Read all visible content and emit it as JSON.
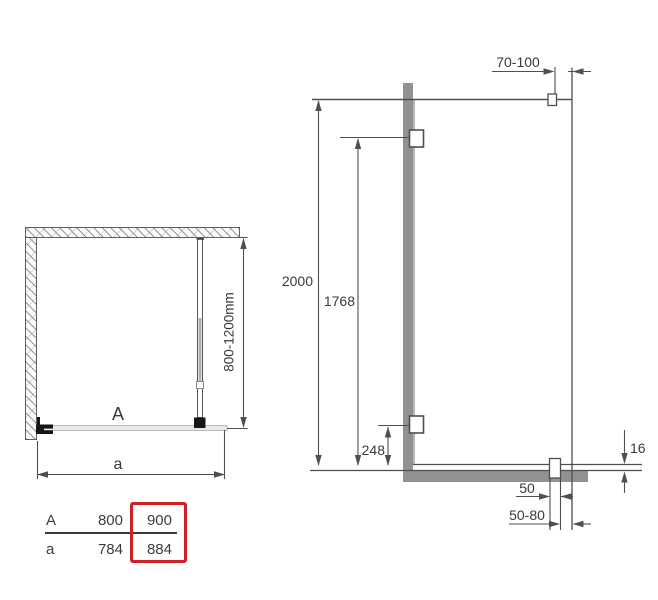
{
  "plan_view": {
    "panel_label": "A",
    "width_label": "a",
    "support_bar_range": "800-1200mm"
  },
  "elevation_view": {
    "total_height": "2000",
    "upper_hinge_height": "1768",
    "lower_hinge_height": "248",
    "support_bar_wall_offset": "70-100",
    "profile_thickness": "16",
    "bracket_width": "50",
    "bracket_wall_offset": "50-80"
  },
  "size_table": {
    "rows": [
      {
        "label": "A",
        "standard": "800",
        "highlighted": "900"
      },
      {
        "label": "a",
        "standard": "784",
        "highlighted": "884"
      }
    ]
  },
  "colors": {
    "highlight_red": "#cc2127",
    "profile_gray": "#919191",
    "glass_gray": "#e9e9e9",
    "line_gray": "#4f4f4f"
  }
}
